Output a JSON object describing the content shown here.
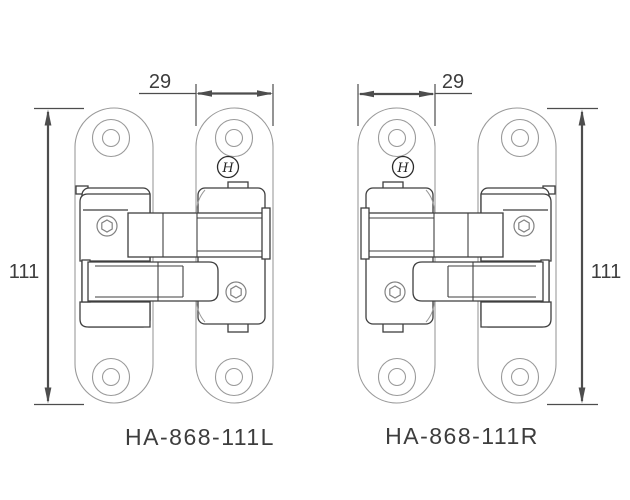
{
  "page": {
    "background": "#ffffff",
    "type": "technical-drawing",
    "subject": "concealed invisible door hinges, left and right hand versions"
  },
  "drawing": {
    "colors": {
      "plate_line": "#9a9a9a",
      "detail_line": "#3f3f3f",
      "screw_line": "#828282",
      "dimension_line": "#4d4d4d",
      "text": "#3d3d3d"
    },
    "emblem_glyph": "H",
    "hinges": [
      {
        "model": "HA-868-111L",
        "width_label": "29",
        "height_label": "111",
        "hand": "left"
      },
      {
        "model": "HA-868-111R",
        "width_label": "29",
        "height_label": "111",
        "hand": "right"
      }
    ]
  }
}
